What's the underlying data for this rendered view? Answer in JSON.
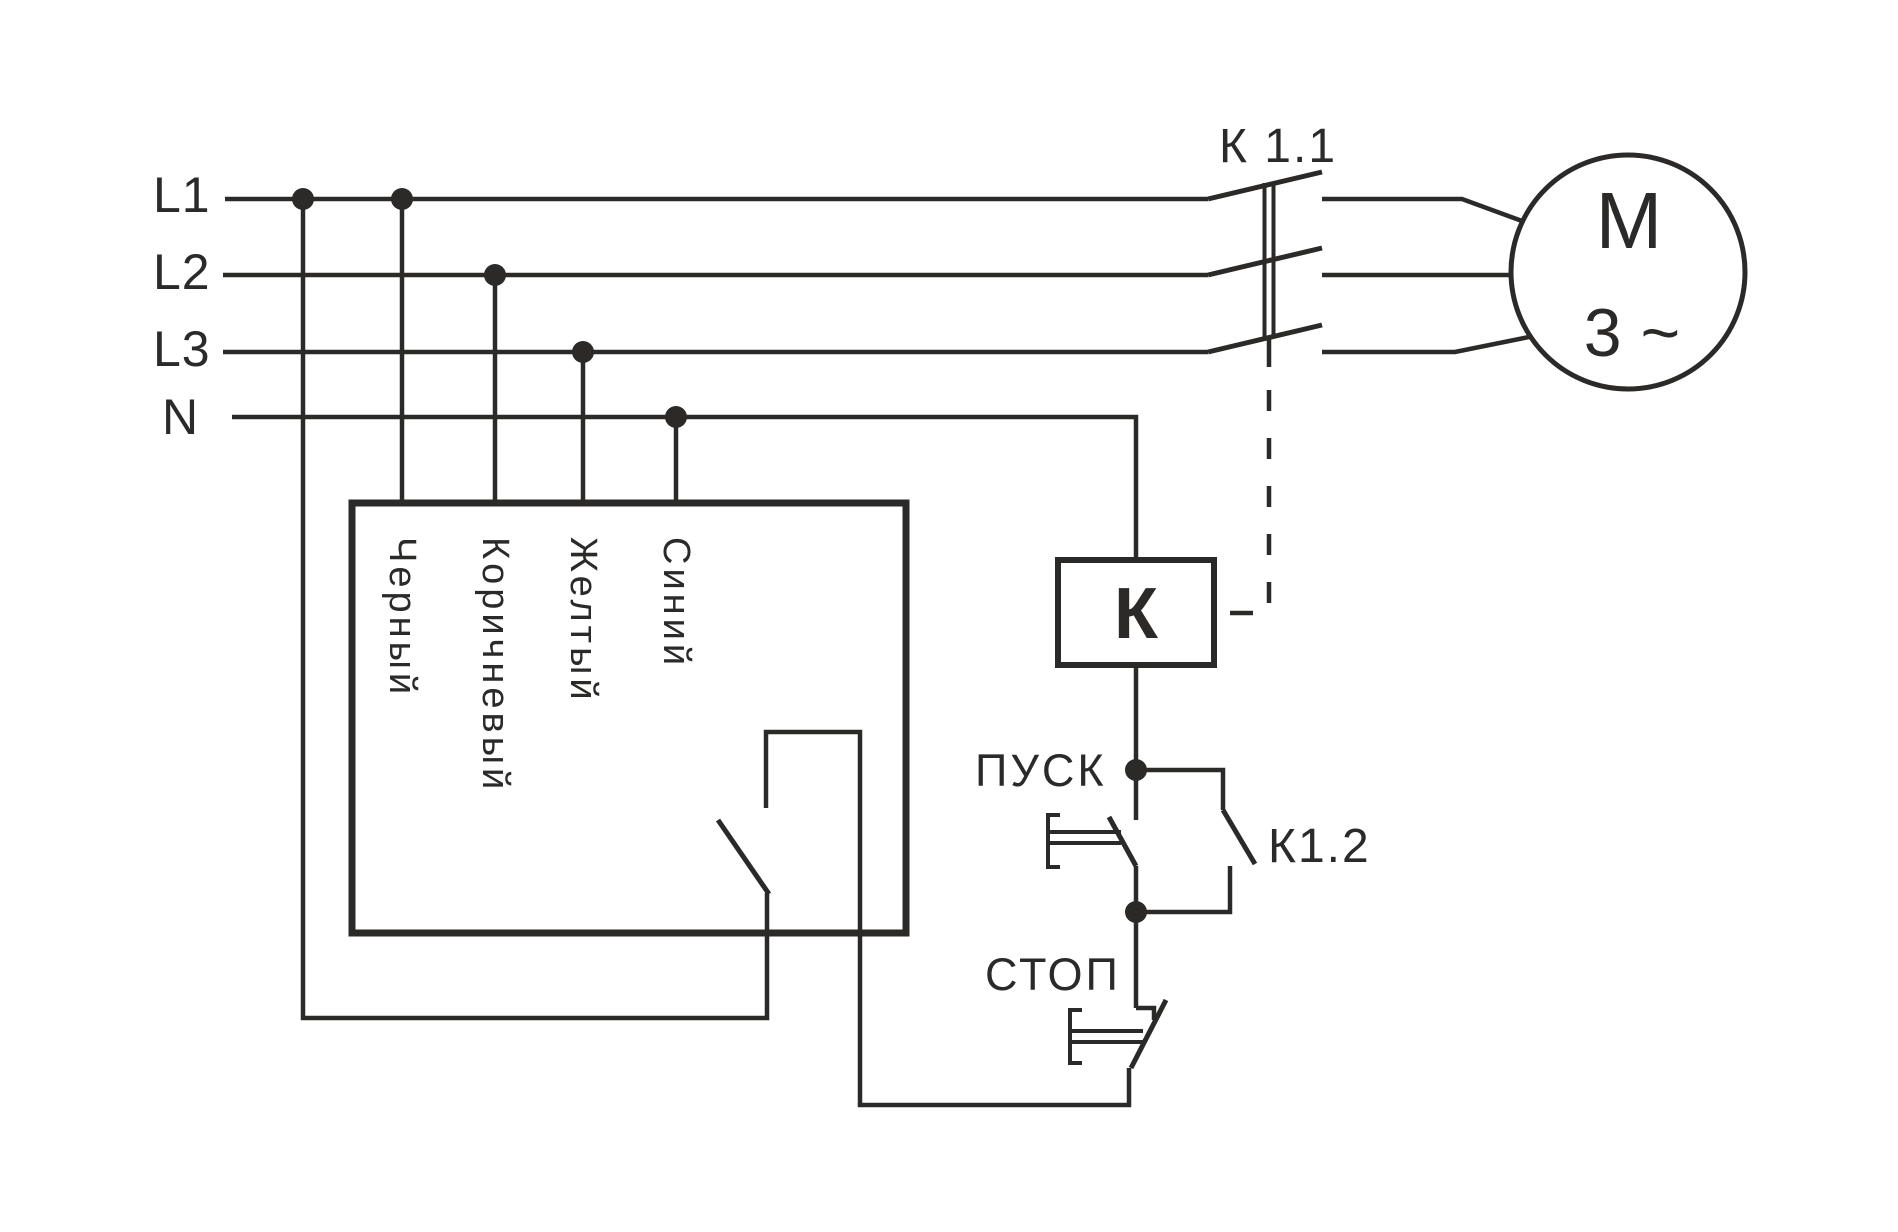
{
  "diagram": {
    "type": "electrical-schematic",
    "colors": {
      "ink": "#2b2a29",
      "background": "#ffffff"
    },
    "power_rails": {
      "l1": "L1",
      "l2": "L2",
      "l3": "L3",
      "n": "N"
    },
    "device_wires": {
      "black": "Черный",
      "brown": "Коричневый",
      "yellow": "Желтый",
      "blue": "Синий"
    },
    "contactor": {
      "main_contacts": "К 1.1",
      "coil": "К",
      "aux_contact": "К1.2"
    },
    "motor": {
      "symbol": "М",
      "phases": "3 ~"
    },
    "buttons": {
      "start": "ПУСК",
      "stop": "СТОП"
    }
  }
}
